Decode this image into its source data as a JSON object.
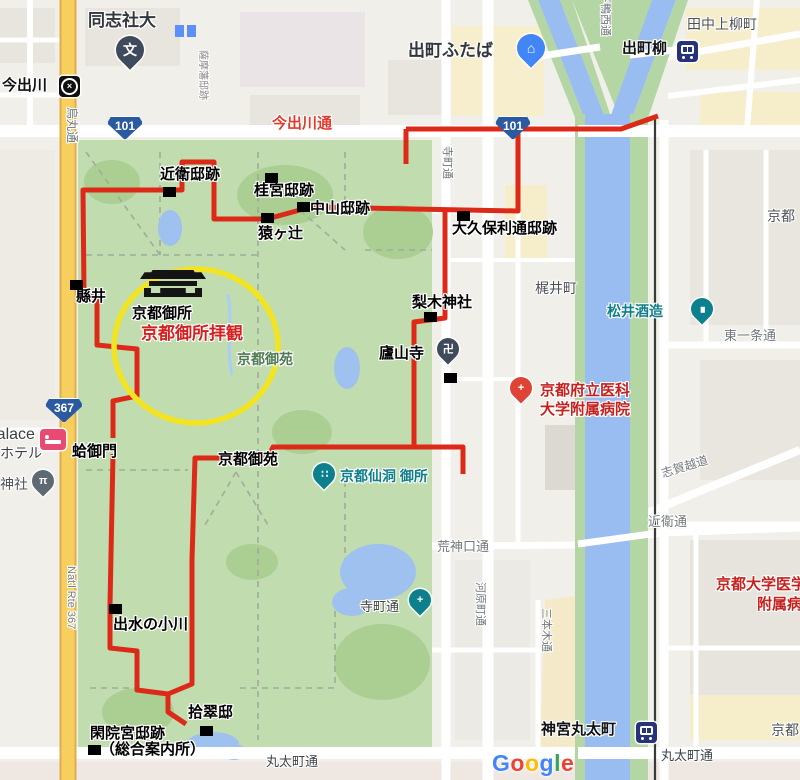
{
  "colors": {
    "route_red": "#dd2a18",
    "highlight_yellow": "#f3e422",
    "park_green": "#c1dcae",
    "water_blue": "#99bdf0",
    "highway_yellow": "#f7cf5f",
    "red_label": "#c5221f",
    "teal_label": "#0d7e8a"
  },
  "annotations": {
    "konoe": "近衛邸跡",
    "katsura": "桂宮邸跡",
    "nakayama": "中山邸跡",
    "sarugatsuji": "猿ヶ辻",
    "okubo": "大久保利通邸跡",
    "agatai": "縣井",
    "gosho": "京都御所",
    "gosho_haikan": "京都御所拝観",
    "gyoen_south": "京都御苑",
    "nashinoki": "梨木神社",
    "rozanji": "廬山寺",
    "hamaguri": "蛤御門",
    "demizu": "出水の小川",
    "kanin_line1": "閑院宮邸跡",
    "kanin_line2": "（総合案内所）",
    "shusuitei": "拾翠邸"
  },
  "pois": {
    "doshisha": "同志社大",
    "imadegawa_station": "今出川",
    "futaba": "出町ふたば",
    "demachiyanagi": "出町柳",
    "tanaka_kamiyanagi": "田中上柳町",
    "kyoto_clip_ne": "京都",
    "kajii_cho": "梶井町",
    "matsui_shuzo": "松井酒造",
    "hospital_line1": "京都府立医科",
    "hospital_line2": "大学附属病院",
    "gyoen_park": "京都御苑",
    "sento_gosho": "京都仙洞 御所",
    "kyodai_line1": "京都大学医学部",
    "kyodai_line2": "附属病院",
    "jingu_marutamachi": "神宮丸太町",
    "shrine": "神社",
    "hotel_line1": "Palace",
    "hotel_line2": "ホテル",
    "kyoto_clip_se": "京都"
  },
  "streets": {
    "imadegawa_dori": "今出川通",
    "karasuma_dori": "烏丸通",
    "natl_rte": "Nat'l Rte 367",
    "teramachi_north": "寺町通",
    "teramachi_south": "寺町通",
    "kawaramachi_dori": "河原町通",
    "sanbongi_dori": "三本木通",
    "kojinguchi_dori": "荒神口通",
    "konoe_dori": "近衛通",
    "higashi_ichijo_dori": "東一条通",
    "shigagoe_michi": "志賀越道",
    "marutamachi_dori_w": "丸太町通",
    "marutamachi_dori_e": "丸太町通",
    "satsuma_hanteiato": "薩摩藩邸跡",
    "shimogamo_nishi_dori": "下鴨西通"
  },
  "shields": {
    "r101": "101",
    "r367": "367"
  },
  "icons": {
    "school_glyph": "文",
    "manji_glyph": "卍",
    "torii_glyph": "π",
    "cross_glyph": "+",
    "hospital_glyph": "+",
    "subway_glyph": "×",
    "sento_glyph": "∷",
    "sake_glyph": "∎",
    "bag_glyph": "⌂"
  },
  "attribution": {
    "letters": [
      "G",
      "o",
      "o",
      "g",
      "l",
      "e"
    ]
  }
}
